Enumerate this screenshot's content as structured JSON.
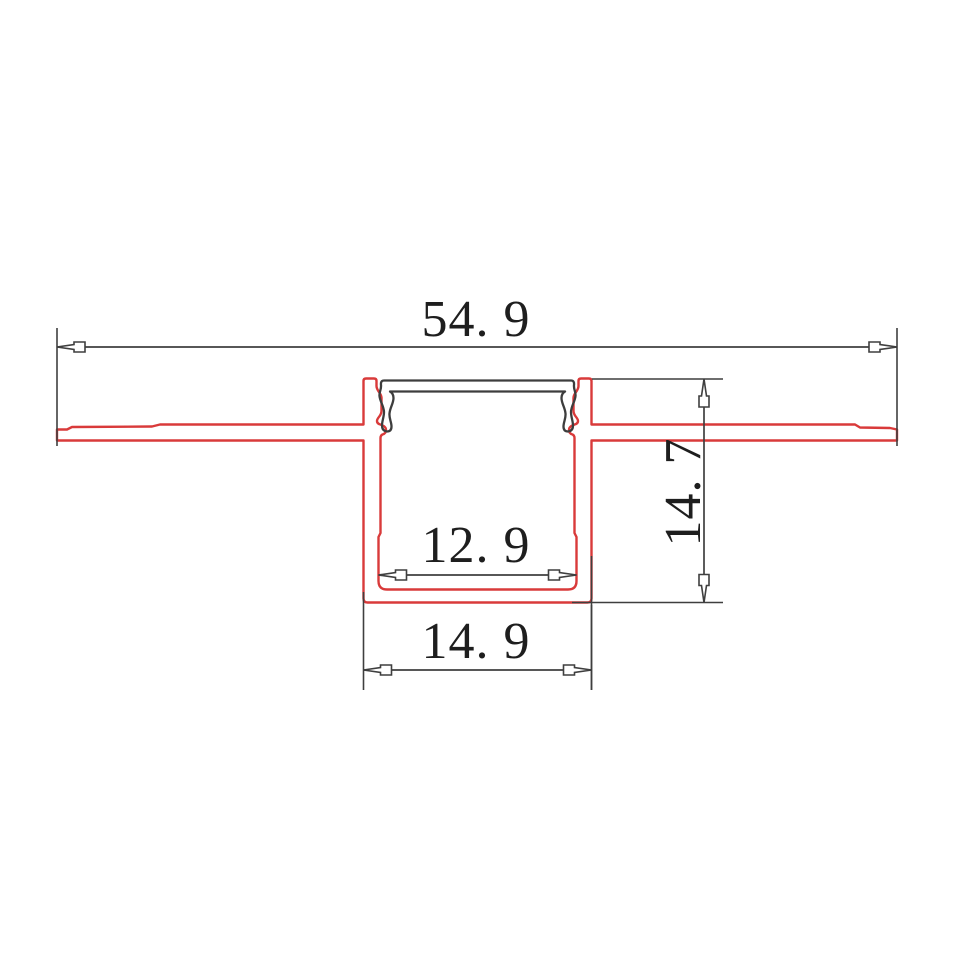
{
  "drawing": {
    "type": "technical-cross-section",
    "dimensions": {
      "overall_width": {
        "label": "54. 9",
        "value": 54.9
      },
      "overall_height": {
        "label": "14. 7",
        "value": 14.7
      },
      "channel_inner_width": {
        "label": "12. 9",
        "value": 12.9
      },
      "channel_outer_width": {
        "label": "14. 9",
        "value": 14.9
      }
    },
    "colors": {
      "profile_outline": "#d93a3a",
      "cover_outline": "#3d3d3d",
      "dimension_color": "#3f3f3f",
      "text_color": "#1e1e1e",
      "background": "#ffffff"
    }
  }
}
